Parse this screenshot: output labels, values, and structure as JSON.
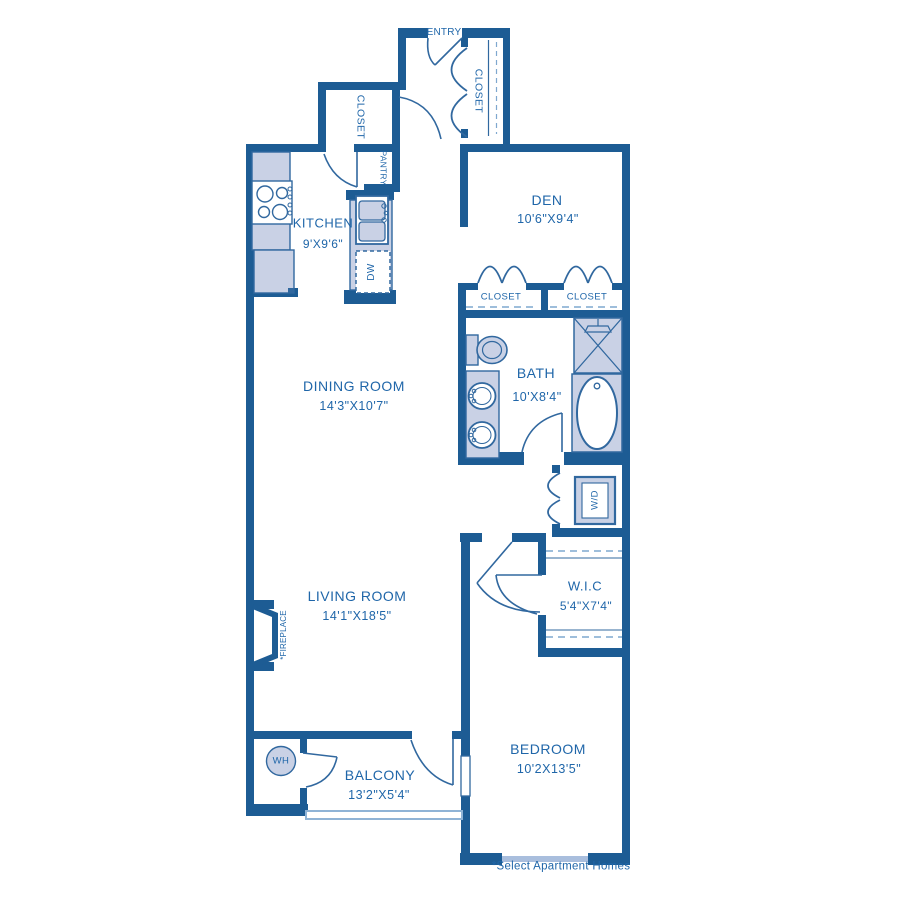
{
  "colors": {
    "wall": "#1d5c94",
    "fixture_fill": "#c9d1e5",
    "fixture_stroke": "#31689f",
    "label_text": "#1f66a9",
    "light_line": "#7fa8cf"
  },
  "rooms": {
    "entry": {
      "label": "ENTRY"
    },
    "entry_closet": {
      "label": "CLOSET"
    },
    "hall_closet": {
      "label": "CLOSET"
    },
    "pantry": {
      "label": "PANTRY"
    },
    "kitchen": {
      "label": "KITCHEN",
      "dims": "9'X9'6\""
    },
    "den": {
      "label": "DEN",
      "dims": "10'6\"X9'4\""
    },
    "den_closet_left": {
      "label": "CLOSET"
    },
    "den_closet_right": {
      "label": "CLOSET"
    },
    "dining_room": {
      "label": "DINING ROOM",
      "dims": "14'3\"X10'7\""
    },
    "bath": {
      "label": "BATH",
      "dims": "10'X8'4\""
    },
    "living_room": {
      "label": "LIVING ROOM",
      "dims": "14'1\"X18'5\""
    },
    "wic": {
      "label": "W.I.C",
      "dims": "5'4\"X7'4\""
    },
    "bedroom": {
      "label": "BEDROOM",
      "dims": "10'2X13'5\""
    },
    "balcony": {
      "label": "BALCONY",
      "dims": "13'2\"X5'4\""
    }
  },
  "fixtures": {
    "washer_dryer": "W/D",
    "dishwasher": "DW",
    "water_heater": "WH",
    "fireplace": "*FIREPLACE"
  },
  "footnote": "*Select Apartment Homes"
}
